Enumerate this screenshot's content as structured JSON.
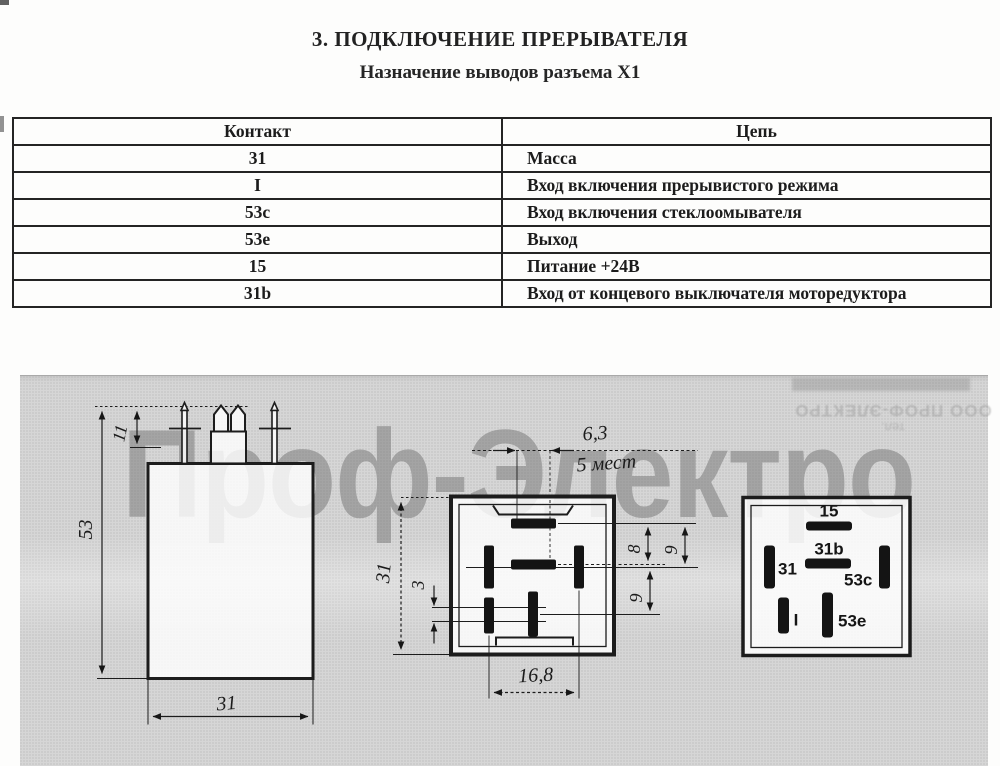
{
  "title": "3. ПОДКЛЮЧЕНИЕ ПРЕРЫВАТЕЛЯ",
  "subtitle": "Назначение выводов разъема X1",
  "table": {
    "headers": {
      "contact": "Контакт",
      "circuit": "Цепь"
    },
    "rows": [
      {
        "contact": "31",
        "circuit": "Масса"
      },
      {
        "contact": "I",
        "circuit": "Вход включения прерывистого режима"
      },
      {
        "contact": "53c",
        "circuit": "Вход включения стеклоомывателя"
      },
      {
        "contact": "53e",
        "circuit": "Выход"
      },
      {
        "contact": "15",
        "circuit": "Питание +24В"
      },
      {
        "contact": "31b",
        "circuit": "Вход от концевого выключателя моторедуктора"
      }
    ]
  },
  "drawing": {
    "watermark": "Проф-Электро",
    "bleed_stamp": {
      "line1": "ООО ПРОФ-ЭЛЕКТРО",
      "line2": "тел."
    },
    "side_view": {
      "total_height": "53",
      "pin_height": "11",
      "body_width": "31"
    },
    "bottom_view": {
      "pin_pitch": "6,3",
      "pitch_places": "5 мест",
      "body_height": "31",
      "offset_small": "3",
      "dim_8": "8",
      "dim_9_top": "9",
      "dim_9_bottom": "9",
      "pin_span": "16,8"
    },
    "pinout_labels": {
      "p15": "15",
      "p31b": "31b",
      "p31": "31",
      "p53c": "53c",
      "pI": "I",
      "p53e": "53e"
    }
  },
  "colors": {
    "panel_gray": "#d6d6d6",
    "line_black": "#1c1c1c",
    "watermark_gray": "#6f6f6f",
    "paper_white": "#fdfdfc"
  }
}
